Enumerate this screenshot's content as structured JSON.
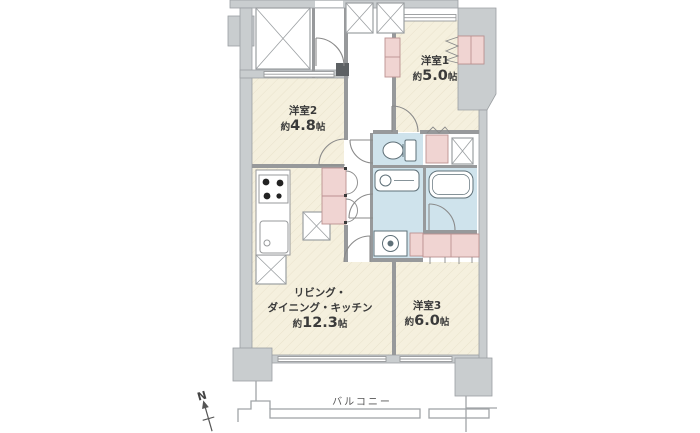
{
  "floorplan": {
    "rooms": [
      {
        "key": "western1",
        "name": "洋室1",
        "area_prefix": "約",
        "area_value": "5.0",
        "area_unit": "帖"
      },
      {
        "key": "western2",
        "name": "洋室2",
        "area_prefix": "約",
        "area_value": "4.8",
        "area_unit": "帖"
      },
      {
        "key": "ldk",
        "name_line1": "リビング・",
        "name_line2": "ダイニング・キッチン",
        "area_prefix": "約",
        "area_value": "12.3",
        "area_unit": "帖"
      },
      {
        "key": "western3",
        "name": "洋室3",
        "area_prefix": "約",
        "area_value": "6.0",
        "area_unit": "帖"
      }
    ],
    "balcony": {
      "label": "バルコニー"
    },
    "compass": {
      "label": "N"
    },
    "colors": {
      "room_floor": "#f5f0de",
      "hatch_line": "#e9e2cb",
      "closet": "#f0d4d2",
      "closet_border": "#bb9191",
      "wet_area": "#cfe3ec",
      "fixture_line": "#5f7078",
      "wall_fill": "#c9cdcf",
      "wall_edge": "#9b9fa2",
      "partition": "#97999b",
      "door_line": "#8a8a8a",
      "balcony_line": "#a0a4a7",
      "text": "#3a3a3a",
      "background": "#ffffff"
    }
  }
}
